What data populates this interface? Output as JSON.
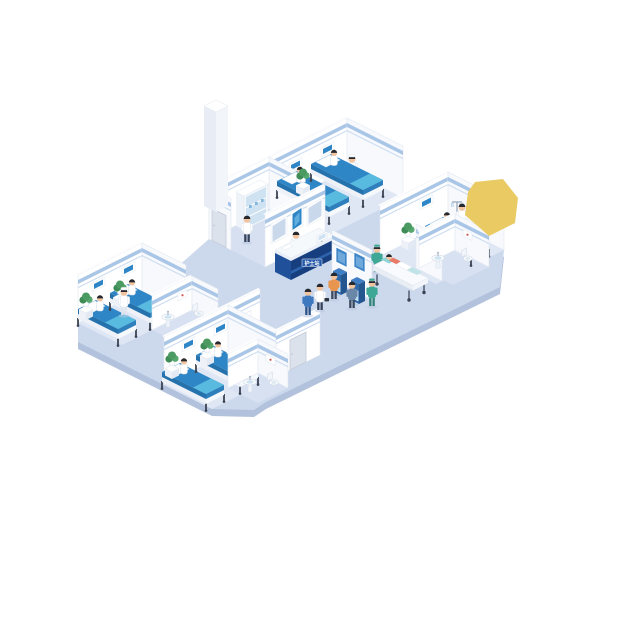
{
  "scene": {
    "title": "Isometric hospital ward illustration",
    "background": "#ffffff"
  },
  "corridor": {
    "reception": {
      "sign_text": "护士站",
      "staff": [
        "receptionist"
      ],
      "wall_screens": 3
    },
    "kiosks": {
      "count": 2,
      "users": 2
    },
    "gurney": {
      "patient": 1,
      "orderly": 1
    },
    "walking": [
      "doctor with bag",
      "staff in blue scrubs",
      "nurse in green scrubs"
    ]
  },
  "rooms": [
    {
      "id": "ward-a",
      "name": "Ward room A",
      "beds": 2,
      "patients": 2,
      "staff": [
        "nurse"
      ],
      "features": [
        "bedside plant",
        "headboard monitors"
      ]
    },
    {
      "id": "ward-b",
      "name": "Ward room B",
      "beds": 1,
      "patients": 1,
      "staff": [
        "doctor"
      ],
      "features": [
        "IV stand",
        "bedside plant",
        "private bathroom"
      ]
    },
    {
      "id": "ward-c",
      "name": "Ward room C",
      "beds": 2,
      "patients": 2,
      "staff": [
        "nurse"
      ],
      "features": [
        "bedside plants",
        "private bathroom"
      ]
    },
    {
      "id": "ward-d",
      "name": "Ward room D",
      "beds": 2,
      "patients": 2,
      "staff": [
        "nurse"
      ],
      "features": [
        "bedside plants",
        "private bathroom"
      ]
    },
    {
      "id": "utility",
      "name": "Staff utility room",
      "beds": 0,
      "patients": 0,
      "staff": [
        "pharmacist"
      ],
      "features": [
        "medicine cabinet",
        "service column"
      ]
    }
  ],
  "palette": {
    "floorCorridor": "#ccd8ec",
    "floorRoom": "#dfe7f5",
    "floorUtility": "#d6e0f1",
    "floorBath": "#d7e1f1",
    "floorEdge": "#b2c1dc",
    "wallNE": "#ffffff",
    "wallSE": "#f7f9fd",
    "wallTop": "#fdfdfe",
    "wallStroke": "#e2e8f1",
    "trim": "#a9c6e7",
    "trimLight": "#cddcf0",
    "screenBlue": "#2f86c6",
    "screenBlueLight": "#61aede",
    "screenGray": "#c9d9eb",
    "poster": "#3f86c8",
    "posterLight": "#6fa9dc",
    "door": "#dce2ec",
    "doorFrame": "#c2cbd9",
    "bedTop": "#2f86c6",
    "bedBlanket": "#57bade",
    "bedSideDark": "#2672ad",
    "bedSideMid": "#2e7fbb",
    "bedFrameSide": "#eef2f8",
    "bedFrameFoot": "#f6f9fc",
    "bedLeg": "#3c4454",
    "plantDark": "#3e8b55",
    "plantMid": "#4a9a62",
    "plantLight": "#56a86e",
    "tableSideL": "#eef2f8",
    "tableSideR": "#e4eaf3",
    "deskSW": "#20509a",
    "deskSE": "#173f80",
    "deskBand": "#e9eff8",
    "deskStripe": "#2d62ad",
    "deskTop": "#f6f9fc",
    "deskSign": "#2458a8",
    "kioskFront": "#2d68aa",
    "kioskSide": "#24578f",
    "kioskTop": "#3f7ec4",
    "kioskScreen": "#a8d4ee",
    "gurneyTop": "#f8fafd",
    "pillowTeal": "#8fd4d8",
    "blanketTeal": "#bfe3e6",
    "colSE": "#f2f5fa",
    "colSW": "#e8edf5",
    "cabSide": "#eef2f9",
    "glass": "#cfe2f2",
    "sinkBasin": "#cfe4f2",
    "artRed": "#cf5b5b",
    "skin": "#f1c49f",
    "hair": "#262a30",
    "shadow": "#b9c6de",
    "yellowShape": "#e9ca63",
    "roles": {
      "nurse": {
        "top": "#ffffff",
        "leg": "#dfe5ee",
        "cap": "#ffffff"
      },
      "doctor": {
        "top": "#ffffff",
        "leg": "#35425c"
      },
      "receptionist": {
        "top": "#ffffff",
        "leg": "#35425c"
      },
      "scrubGreen": {
        "top": "#3fa796",
        "leg": "#2f8276",
        "cap": "#3fa796"
      },
      "scrubBlue": {
        "top": "#3e78bf",
        "leg": "#2c5186"
      },
      "visitorOrange": {
        "top": "#e8954f",
        "leg": "#39465c"
      },
      "visitorBlue": {
        "top": "#6b87a8",
        "leg": "#39465c"
      }
    }
  },
  "silhouette": [
    [
      347,
      170
    ],
    [
      504,
      250
    ],
    [
      500,
      287
    ],
    [
      266,
      402
    ],
    [
      254,
      410
    ],
    [
      212,
      409
    ],
    [
      78,
      342
    ],
    [
      78,
      323
    ],
    [
      142,
      291
    ],
    [
      160,
      282
    ],
    [
      209,
      239
    ],
    [
      269,
      209
    ]
  ],
  "layout": [
    {
      "t": "edge",
      "name": "floor-edge"
    },
    {
      "t": "sil",
      "name": "corridor-floor",
      "fill": "floorCorridor"
    },
    {
      "t": "poly",
      "name": "ward-a-floor",
      "fill": "floorRoom",
      "pts": [
        [
          347,
          170
        ],
        [
          403,
          198
        ],
        [
          325,
          237
        ],
        [
          269,
          209
        ]
      ]
    },
    {
      "t": "poly",
      "name": "utility-floor",
      "fill": "floorUtility",
      "pts": [
        [
          269,
          209
        ],
        [
          325,
          237
        ],
        [
          265,
          267
        ],
        [
          209,
          239
        ]
      ]
    },
    {
      "t": "poly",
      "name": "ward-b-floor",
      "fill": "floorRoom",
      "pts": [
        [
          448,
          222
        ],
        [
          504,
          250
        ],
        [
          436,
          284
        ],
        [
          380,
          256
        ]
      ]
    },
    {
      "t": "poly",
      "name": "ward-c-floor",
      "fill": "floorRoom",
      "pts": [
        [
          142,
          291
        ],
        [
          186,
          313
        ],
        [
          122,
          345
        ],
        [
          78,
          323
        ]
      ]
    },
    {
      "t": "poly",
      "name": "ward-d-floor",
      "fill": "floorRoom",
      "pts": [
        [
          228,
          353
        ],
        [
          276,
          377
        ],
        [
          212,
          409
        ],
        [
          164,
          385
        ]
      ]
    },
    {
      "t": "poly",
      "name": "bath-b-floor",
      "fill": "floorBath",
      "pts": [
        [
          455,
          250
        ],
        [
          489,
          267
        ],
        [
          453,
          285
        ],
        [
          419,
          268
        ]
      ]
    },
    {
      "t": "poly",
      "name": "bath-c-floor",
      "fill": "floorBath",
      "pts": [
        [
          192,
          310
        ],
        [
          218,
          323
        ],
        [
          178,
          343
        ],
        [
          152,
          330
        ]
      ]
    },
    {
      "t": "poly",
      "name": "bath-d-floor",
      "fill": "floorBath",
      "pts": [
        [
          258,
          373
        ],
        [
          288,
          388
        ],
        [
          258,
          403
        ],
        [
          228,
          388
        ]
      ]
    },
    {
      "t": "wall",
      "dir": "ne",
      "x": 269,
      "y": 209,
      "len": 78,
      "h": 52,
      "panels": [
        {
          "d": 20,
          "z": 26
        },
        {
          "d": 52,
          "z": 26
        }
      ],
      "name": "ward-a-back-wall"
    },
    {
      "t": "wall",
      "dir": "se",
      "x": 347,
      "y": 170,
      "len": 56,
      "h": 52,
      "name": "ward-a-side-wall"
    },
    {
      "t": "wall",
      "dir": "se",
      "x": 269,
      "y": 209,
      "len": 56,
      "h": 52,
      "name": "ward-a-partition-wall"
    },
    {
      "t": "person",
      "x": 352,
      "y": 182,
      "role": "nurse",
      "name": "ward-a-nurse"
    },
    {
      "t": "bed",
      "x": 297,
      "y": 187,
      "len": 52,
      "w": 20,
      "patient": true,
      "name": "ward-a-bed-1"
    },
    {
      "t": "bed",
      "x": 331,
      "y": 170,
      "len": 52,
      "w": 20,
      "patient": true,
      "name": "ward-a-bed-2"
    },
    {
      "t": "plant",
      "x": 303,
      "y": 194,
      "name": "ward-a-plant"
    },
    {
      "t": "wall",
      "dir": "ne",
      "x": 209,
      "y": 239,
      "len": 60,
      "h": 52,
      "name": "utility-back-wall"
    },
    {
      "t": "wall",
      "dir": "se",
      "x": 209,
      "y": 239,
      "len": 22,
      "h": 52,
      "door": {
        "d": 3,
        "w": 14,
        "h": 32
      },
      "name": "utility-side-wall"
    },
    {
      "t": "column",
      "x": 216,
      "y": 206,
      "name": "service-column"
    },
    {
      "t": "cabinet",
      "x": 236,
      "y": 226,
      "name": "medicine-cabinet"
    },
    {
      "t": "person",
      "x": 247,
      "y": 242,
      "role": "doctor",
      "name": "pharmacist"
    },
    {
      "t": "wall",
      "dir": "ne",
      "x": 265,
      "y": 267,
      "len": 60,
      "h": 52,
      "screens": true,
      "name": "imaging-wall"
    },
    {
      "t": "person",
      "x": 296,
      "y": 258,
      "role": "receptionist",
      "name": "receptionist"
    },
    {
      "t": "desk",
      "x": 275,
      "y": 272,
      "name": "reception-desk"
    },
    {
      "t": "wall",
      "dir": "se",
      "x": 332,
      "y": 280,
      "len": 40,
      "h": 50,
      "posters": [
        {
          "d": 4,
          "z": 20
        },
        {
          "d": 22,
          "z": 24
        }
      ],
      "name": "kiosk-wall"
    },
    {
      "t": "kiosk",
      "x": 339,
      "y": 288,
      "name": "self-service-kiosk-1"
    },
    {
      "t": "kiosk",
      "x": 357,
      "y": 297,
      "name": "self-service-kiosk-2"
    },
    {
      "t": "person",
      "x": 334,
      "y": 299,
      "role": "visitorOrange",
      "name": "kiosk-user-1"
    },
    {
      "t": "person",
      "x": 352,
      "y": 308,
      "role": "visitorBlue",
      "name": "kiosk-user-2"
    },
    {
      "t": "wall",
      "dir": "ne",
      "x": 380,
      "y": 256,
      "len": 68,
      "h": 50,
      "panels": [
        {
          "d": 40,
          "z": 26
        }
      ],
      "name": "ward-b-back-wall"
    },
    {
      "t": "wall",
      "dir": "se",
      "x": 448,
      "y": 222,
      "len": 56,
      "h": 50,
      "name": "ward-b-side-wall"
    },
    {
      "t": "wall",
      "dir": "se",
      "x": 416,
      "y": 268,
      "len": 26,
      "h": 44,
      "posters": [
        {
          "d": 5,
          "z": 18
        }
      ],
      "name": "corridor-poster-wall"
    },
    {
      "t": "person",
      "x": 377,
      "y": 272,
      "role": "scrubGreen",
      "name": "gurney-orderly"
    },
    {
      "t": "gurney",
      "x": 388,
      "y": 274,
      "name": "patient-gurney"
    },
    {
      "t": "bed",
      "x": 443,
      "y": 233,
      "len": 46,
      "w": 18,
      "patient": true,
      "name": "ward-b-bed"
    },
    {
      "t": "plant",
      "x": 408,
      "y": 248,
      "name": "ward-b-plant"
    },
    {
      "t": "iv",
      "x": 457,
      "y": 229,
      "name": "iv-stand"
    },
    {
      "t": "person",
      "x": 462,
      "y": 230,
      "role": "doctor",
      "name": "ward-b-doctor"
    },
    {
      "t": "wall",
      "dir": "ne",
      "x": 419,
      "y": 268,
      "len": 36,
      "h": 36,
      "name": "bath-b-back-wall"
    },
    {
      "t": "wall",
      "dir": "se",
      "x": 455,
      "y": 250,
      "len": 34,
      "h": 36,
      "art": [
        {
          "d": 8,
          "z": 18
        }
      ],
      "name": "bath-b-side-wall"
    },
    {
      "t": "sink",
      "x": 438,
      "y": 268,
      "name": "bath-b-sink"
    },
    {
      "t": "toilet",
      "x": 466,
      "y": 262,
      "name": "bath-b-toilet"
    },
    {
      "t": "wall",
      "dir": "ne",
      "x": 78,
      "y": 323,
      "len": 64,
      "h": 48,
      "panels": [
        {
          "d": 14,
          "z": 24
        },
        {
          "d": 44,
          "z": 24
        }
      ],
      "name": "ward-c-back-wall"
    },
    {
      "t": "wall",
      "dir": "se",
      "x": 142,
      "y": 291,
      "len": 44,
      "h": 48,
      "name": "ward-c-side-wall"
    },
    {
      "t": "bed",
      "x": 96,
      "y": 316,
      "len": 40,
      "w": 18,
      "patient": true,
      "name": "ward-c-bed-1"
    },
    {
      "t": "bed",
      "x": 128,
      "y": 300,
      "len": 40,
      "w": 18,
      "patient": true,
      "name": "ward-c-bed-2"
    },
    {
      "t": "plant",
      "x": 86,
      "y": 318,
      "name": "ward-c-plant-1"
    },
    {
      "t": "plant",
      "x": 120,
      "y": 306,
      "name": "ward-c-plant-2"
    },
    {
      "t": "person",
      "x": 124,
      "y": 315,
      "role": "nurse",
      "name": "ward-c-nurse"
    },
    {
      "t": "wall",
      "dir": "ne",
      "x": 152,
      "y": 330,
      "len": 40,
      "h": 34,
      "art": [
        {
          "d": 26,
          "z": 16
        }
      ],
      "name": "bath-c-back-wall"
    },
    {
      "t": "wall",
      "dir": "se",
      "x": 192,
      "y": 310,
      "len": 26,
      "h": 34,
      "name": "bath-c-side-wall"
    },
    {
      "t": "sink",
      "x": 168,
      "y": 327,
      "name": "bath-c-sink"
    },
    {
      "t": "toilet",
      "x": 197,
      "y": 317,
      "name": "bath-c-toilet"
    },
    {
      "t": "person",
      "x": 246,
      "y": 330,
      "role": "nurse",
      "name": "ward-d-nurse"
    },
    {
      "t": "wall",
      "dir": "ne",
      "x": 164,
      "y": 385,
      "len": 96,
      "h": 48,
      "panels": [
        {
          "d": 18,
          "z": 24
        },
        {
          "d": 50,
          "z": 24
        }
      ],
      "art": [
        {
          "d": 78,
          "z": 24
        }
      ],
      "name": "ward-d-back-wall"
    },
    {
      "t": "wall",
      "dir": "se",
      "x": 228,
      "y": 353,
      "len": 48,
      "h": 48,
      "name": "ward-d-side-wall"
    },
    {
      "t": "wall",
      "dir": "ne",
      "x": 276,
      "y": 377,
      "len": 44,
      "h": 46,
      "door": {
        "d": 14,
        "w": 16,
        "h": 30
      },
      "name": "ward-d-corridor-wall"
    },
    {
      "t": "bed",
      "x": 180,
      "y": 379,
      "len": 44,
      "w": 18,
      "patient": true,
      "name": "ward-d-bed-1"
    },
    {
      "t": "bed",
      "x": 214,
      "y": 362,
      "len": 44,
      "w": 18,
      "patient": true,
      "name": "ward-d-bed-2"
    },
    {
      "t": "plant",
      "x": 172,
      "y": 377,
      "name": "ward-d-plant-1"
    },
    {
      "t": "plant",
      "x": 207,
      "y": 364,
      "name": "ward-d-plant-2"
    },
    {
      "t": "wall",
      "dir": "ne",
      "x": 228,
      "y": 388,
      "len": 30,
      "h": 34,
      "name": "bath-d-back-wall"
    },
    {
      "t": "wall",
      "dir": "se",
      "x": 258,
      "y": 373,
      "len": 30,
      "h": 34,
      "art": [
        {
          "d": 8,
          "z": 16
        }
      ],
      "name": "bath-d-side-wall"
    },
    {
      "t": "sink",
      "x": 250,
      "y": 392,
      "name": "bath-d-sink"
    },
    {
      "t": "toilet",
      "x": 272,
      "y": 386,
      "name": "bath-d-toilet"
    },
    {
      "t": "person",
      "x": 308,
      "y": 315,
      "role": "scrubBlue",
      "name": "walking-staff"
    },
    {
      "t": "person",
      "x": 320,
      "y": 310,
      "role": "doctor",
      "bag": true,
      "name": "walking-doctor"
    },
    {
      "t": "person",
      "x": 372,
      "y": 306,
      "role": "scrubGreen",
      "name": "walking-nurse"
    },
    {
      "t": "blob",
      "name": "yellow-shape",
      "pts": [
        [
          475,
          182
        ],
        [
          503,
          179
        ],
        [
          518,
          198
        ],
        [
          515,
          223
        ],
        [
          489,
          236
        ],
        [
          465,
          215
        ],
        [
          468,
          192
        ]
      ]
    }
  ]
}
